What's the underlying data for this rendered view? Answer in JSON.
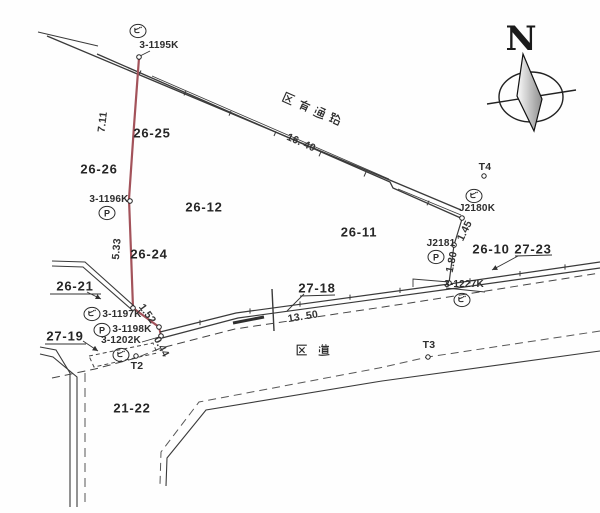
{
  "map": {
    "type": "cadastral-survey-map",
    "compass_label": "N",
    "roads": {
      "upper_road": "区有通路",
      "lower_road": "区道"
    },
    "parcels": {
      "p26_25": "26-25",
      "p26_26": "26-26",
      "p26_12": "26-12",
      "p26_11": "26-11",
      "p26_24": "26-24",
      "p26_10": "26-10",
      "p26_21": "26-21",
      "p27_19": "27-19",
      "p27_18": "27-18",
      "p27_23": "27-23",
      "p21_22": "21-22"
    },
    "measurements": {
      "m7_11": "7.11",
      "m16_40": "16. 40",
      "m5_33": "5.33",
      "m1_52": "1.52",
      "m0_44": "0.44",
      "m13_50": "13. 50",
      "m1_45": "1.45",
      "m1_80": "1.80"
    },
    "survey_points": {
      "p3_1195k": {
        "label": "3-1195K",
        "marker": "ビ"
      },
      "p3_1196k": {
        "label": "3-1196K",
        "marker": "P"
      },
      "p3_1197k": {
        "label": "3-1197K",
        "marker": "ビ"
      },
      "p3_1198k": {
        "label": "3-1198K",
        "marker": "P"
      },
      "p3_1202k": {
        "label": "3-1202K",
        "marker": "ビ"
      },
      "p3_1227k": {
        "label": "3-1227K",
        "marker": "ビ"
      },
      "pj2180k": {
        "label": "J2180K",
        "marker": "ビ"
      },
      "pj2181": {
        "label": "J2181",
        "marker": "P"
      }
    },
    "traverse_points": {
      "t2": "T2",
      "t3": "T3",
      "t4": "T4"
    },
    "colors": {
      "highlight_boundary": "#a3525a",
      "line": "#3a3a3a",
      "background": "#ffffff"
    }
  }
}
